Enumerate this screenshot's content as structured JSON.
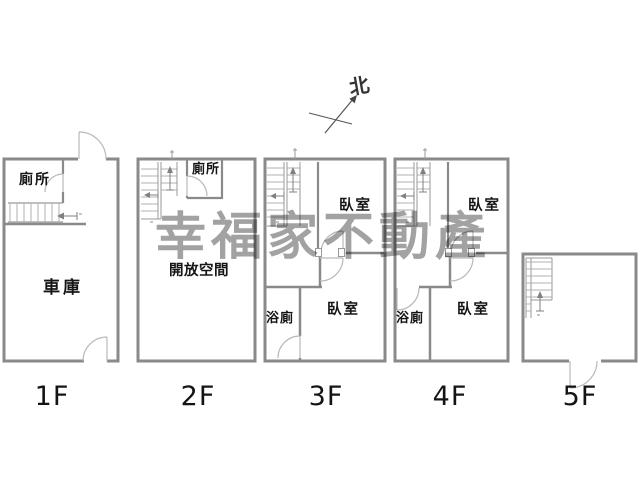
{
  "title": "multi-storey townhouse floor plan",
  "watermark": {
    "text": "幸福家不動產",
    "color": "#a2a2a2"
  },
  "compass": {
    "label": "北"
  },
  "colors": {
    "wall": "#8a8a8a",
    "stair_line": "#b0b0b0",
    "door_arc": "#b9b9b9",
    "text": "#151515",
    "background": "#ffffff"
  },
  "floors": [
    {
      "label": "1F",
      "rooms": {
        "toilet": "廁所",
        "garage": "車庫"
      }
    },
    {
      "label": "2F",
      "rooms": {
        "toilet": "廁所",
        "open_space": "開放空間"
      }
    },
    {
      "label": "3F",
      "rooms": {
        "bedroom_top": "臥室",
        "bath": "浴廁",
        "bedroom_bottom": "臥室"
      }
    },
    {
      "label": "4F",
      "rooms": {
        "bedroom_top": "臥室",
        "bath": "浴廁",
        "bedroom_bottom": "臥室"
      }
    },
    {
      "label": "5F",
      "rooms": {}
    }
  ]
}
